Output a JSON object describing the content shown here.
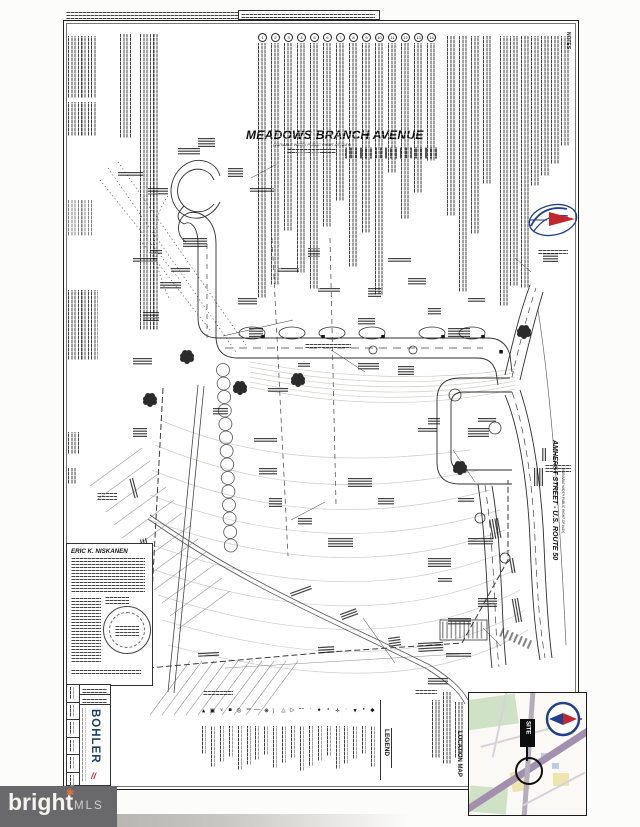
{
  "streets": {
    "meadows_branch": {
      "name": "MEADOWS BRANCH AVENUE",
      "row_note": "(VARIABLE WIDTH PUBLIC RIGHT-OF-WAY)"
    },
    "amherst": {
      "name": "AMHERST STREET - U.S. ROUTE 50",
      "row_note": "(VARIABLE WIDTH PUBLIC RIGHT-OF-WAY)"
    }
  },
  "notes_section": {
    "header": "NOTES",
    "column_numbers": [
      "1",
      "2",
      "3",
      "4",
      "5",
      "6",
      "7",
      "8",
      "9",
      "10",
      "11",
      "12",
      "13",
      "14"
    ]
  },
  "legend": {
    "title": "LEGEND",
    "items": [
      {
        "glyph": "◄",
        "name": "arrow-left-marker"
      },
      {
        "glyph": "▣",
        "name": "inlet-grate"
      },
      {
        "glyph": "»",
        "name": "double-arrow"
      },
      {
        "glyph": "■",
        "name": "square-marker"
      },
      {
        "glyph": "◎",
        "name": "manhole"
      },
      {
        "glyph": "‖",
        "name": "double-line"
      },
      {
        "glyph": "│",
        "name": "pole"
      },
      {
        "glyph": "❋",
        "name": "tree"
      },
      {
        "glyph": "︵",
        "name": "arc-line"
      },
      {
        "glyph": "◁",
        "name": "open-arrow"
      },
      {
        "glyph": "△",
        "name": "delta-marker"
      },
      {
        "glyph": "¦",
        "name": "broken-line"
      },
      {
        "glyph": "∙",
        "name": "dot-small"
      },
      {
        "glyph": "●",
        "name": "filled-circle"
      },
      {
        "glyph": "•",
        "name": "bullet"
      },
      {
        "glyph": "✛",
        "name": "cross-marker"
      },
      {
        "glyph": "·",
        "name": "tick"
      },
      {
        "glyph": "►",
        "name": "arrow-right-marker"
      },
      {
        "glyph": "▪",
        "name": "square-small"
      },
      {
        "glyph": "◆",
        "name": "diamond-marker"
      }
    ]
  },
  "location_map": {
    "title": "LOCATION MAP",
    "site_label": "SITE"
  },
  "seal": {
    "engineer_name": "ERIC K. NISKANEN"
  },
  "firm": {
    "name": "BOHLER",
    "slashes": "//"
  },
  "watermark": {
    "word": "bright",
    "suffix": "MLS",
    "spark": "✱"
  },
  "colors": {
    "ink": "#1c1c1c",
    "contour": "#c8c8c2",
    "navy": "#1c3f6e",
    "compass_navy": "#23408f",
    "red": "#c8202f",
    "map_road": "#a290ae",
    "map_green": "#cfe2c6",
    "map_yellow": "#eee5ae",
    "watermark_bg": "#69696b"
  }
}
